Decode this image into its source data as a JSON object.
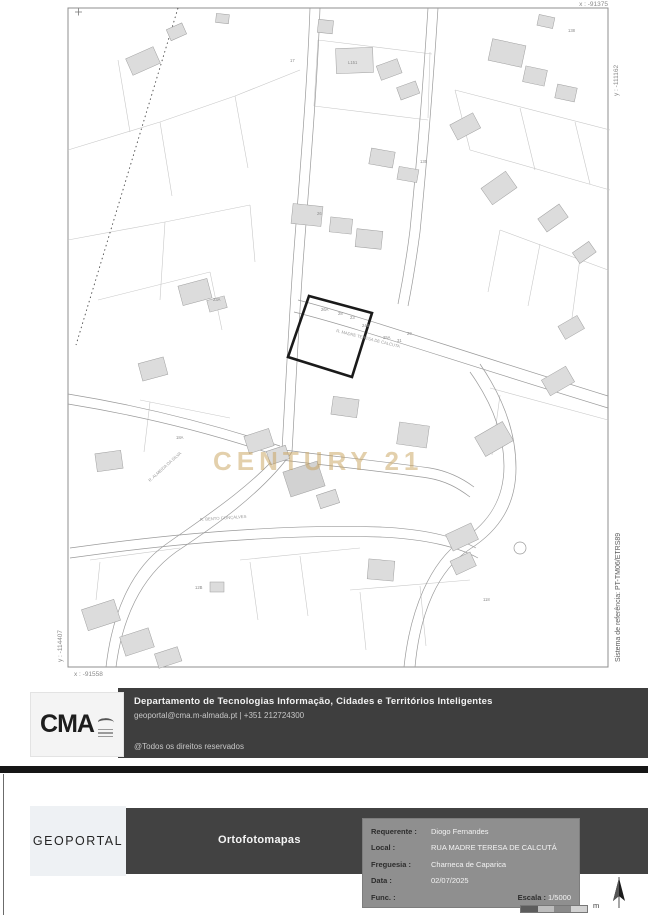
{
  "map": {
    "watermark": "CENTURY 21",
    "reference_system": "Sistema de referência: PT-TM06/ETRS89",
    "coordinates": {
      "top_right_x": "x : -91375",
      "right_y": "y : -111162",
      "left_y": "y : -114407",
      "bottom_left_x": "x : -91558"
    },
    "street_labels": {
      "madre_teresa": "R. MADRE TERESA DE CALCUTA",
      "bento_goncalves": "R. BENTO GONÇALVES",
      "almeida_silva": "R. ALMEIDA DA SILVA"
    },
    "parcel_labels": [
      "17",
      "L151",
      "138",
      "26A",
      "28",
      "23",
      "24B",
      "25A",
      "31",
      "29",
      "18A",
      "26",
      "12B",
      "135",
      "118",
      "23A"
    ]
  },
  "department_banner": {
    "logo": "CMA",
    "title": "Departamento de Tecnologias Informação, Cidades e Territórios Inteligentes",
    "contact": "geoportal@cma.m-almada.pt | +351 212724300",
    "rights": "@Todos os direitos reservados"
  },
  "document_banner": {
    "logo": "GEOPORTAL",
    "title": "Ortofotomapas",
    "form": {
      "rows": [
        {
          "label": "Requerente :",
          "value": "Diogo Fernandes"
        },
        {
          "label": "Local :",
          "value": "RUA MADRE TERESA DE CALCUTÁ"
        },
        {
          "label": "Freguesia :",
          "value": "Charneca de Caparica"
        },
        {
          "label": "Data :",
          "value": "02/07/2025"
        },
        {
          "label": "Func. :",
          "value": ""
        }
      ],
      "scale_label": "Escala :",
      "scale_value": "1/5000"
    },
    "scalebar_unit": "m"
  }
}
